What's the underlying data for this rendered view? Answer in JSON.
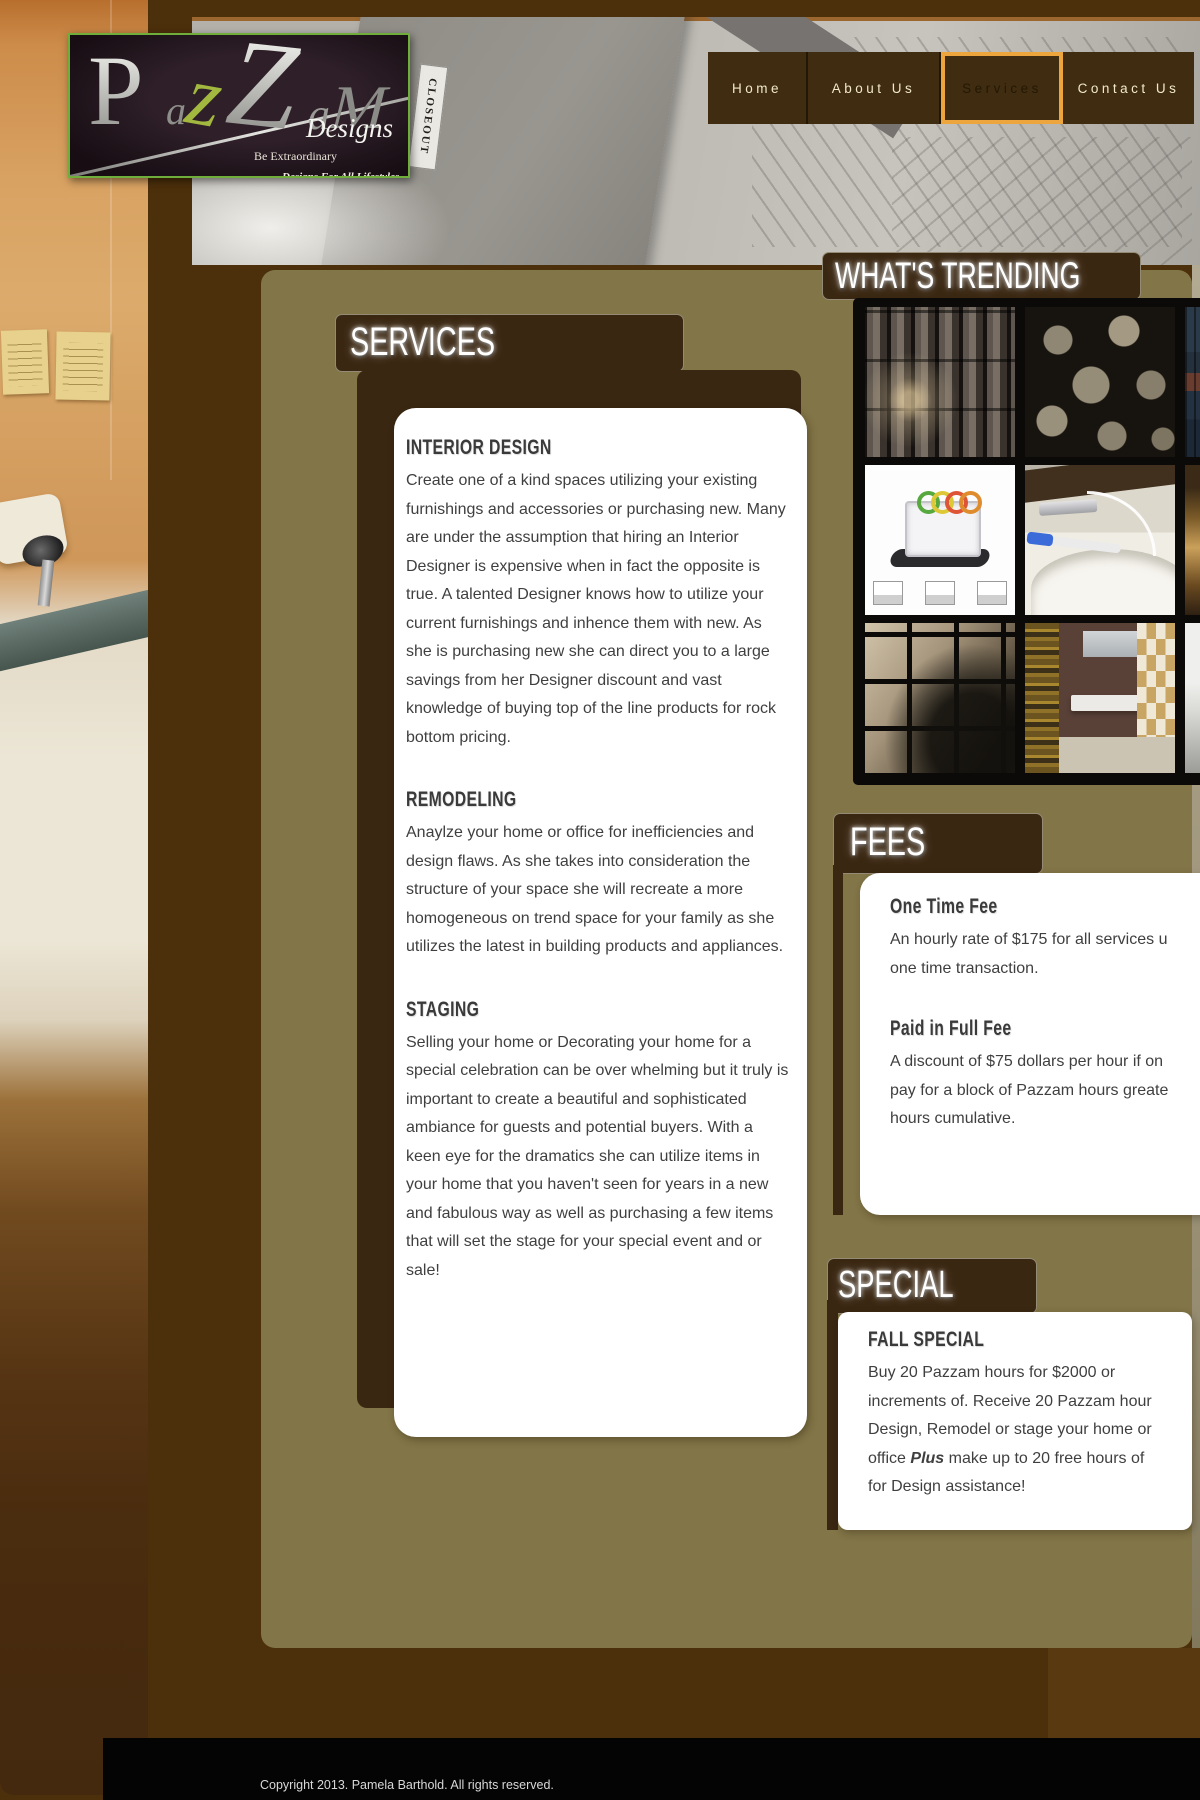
{
  "logo": {
    "letters": [
      "P",
      "a",
      "z",
      "Z",
      "a",
      "M"
    ],
    "designs": "Designs",
    "tagline1": "Be Extraordinary",
    "tagline2": "Designs For All Lifestyles",
    "closeout_tag": "CLOSEOUT"
  },
  "nav": {
    "items": [
      {
        "label": "Home",
        "active": false
      },
      {
        "label": "About Us",
        "active": false
      },
      {
        "label": "Services",
        "active": true
      },
      {
        "label": "Contact Us",
        "active": false
      }
    ]
  },
  "trending": {
    "title": "WHAT'S TRENDING",
    "images": [
      "metallic-subway-tiles",
      "stone-pebble-mosaic",
      "blue-tile-detail",
      "vegetable-slicer-appliance",
      "waterfall-faucet-with-toothbrush",
      "amber-tile-detail",
      "stainless-square-mosaic",
      "klimt-art-bathroom-vanity",
      "modern-sink-detail"
    ]
  },
  "services": {
    "banner": "SERVICES",
    "sections": [
      {
        "heading": "INTERIOR DESIGN",
        "body": "Create one of a kind spaces utilizing your existing furnishings and accessories or purchasing new. Many are under the assumption that hiring an Interior Designer is expensive when in fact the opposite is true. A talented Designer knows how to utilize your current furnishings and inhence them with new. As she is purchasing new she can direct you to a large savings from her Designer discount and vast knowledge of buying top of the line products for rock bottom pricing."
      },
      {
        "heading": "REMODELING",
        "body": "Anaylze your home or office for inefficiencies and design flaws. As she takes into consideration the structure of your space she will recreate a more homogeneous on trend space for your family as she utilizes the latest in building products and appliances."
      },
      {
        "heading": "STAGING",
        "body": "Selling your home or Decorating your home for a special celebration can be over whelming but it truly is important to create a beautiful and sophisticated ambiance for guests and potential buyers. With a keen eye for the dramatics she can utilize items in your home that you haven't seen for years in a new and fabulous way as well as purchasing a few items that will set the stage for your special event and or sale!"
      }
    ]
  },
  "fees": {
    "banner": "FEES",
    "items": [
      {
        "heading": "One Time Fee",
        "body": "An hourly rate of $175 for all services u\none time transaction."
      },
      {
        "heading": "Paid in Full Fee",
        "body": "A discount of $75 dollars per hour if on\npay for a block of Pazzam hours greate\nhours cumulative."
      }
    ]
  },
  "special": {
    "banner": "SPECIAL",
    "heading": "FALL SPECIAL",
    "body_before": "Buy 20 Pazzam hours for $2000 or\nincrements of. Receive 20 Pazzam hour\nDesign, Remodel or stage your home or\noffice ",
    "plus_word": "Plus",
    "body_after": " make up to 20 free hours of\nfor Design assistance!"
  },
  "footer": {
    "copyright": "Copyright 2013. Pamela Barthold. All rights reserved."
  },
  "colors": {
    "page_background": "#4c2f0b",
    "olive_content": "#827547",
    "banner_brown": "#3a2712",
    "nav_button": "#402c11",
    "active_accent_orange": "#eda63d",
    "logo_border_green": "#6fae3a",
    "panel_white": "#ffffff",
    "body_text": "#3f3f3f",
    "footer_black": "#040404"
  }
}
